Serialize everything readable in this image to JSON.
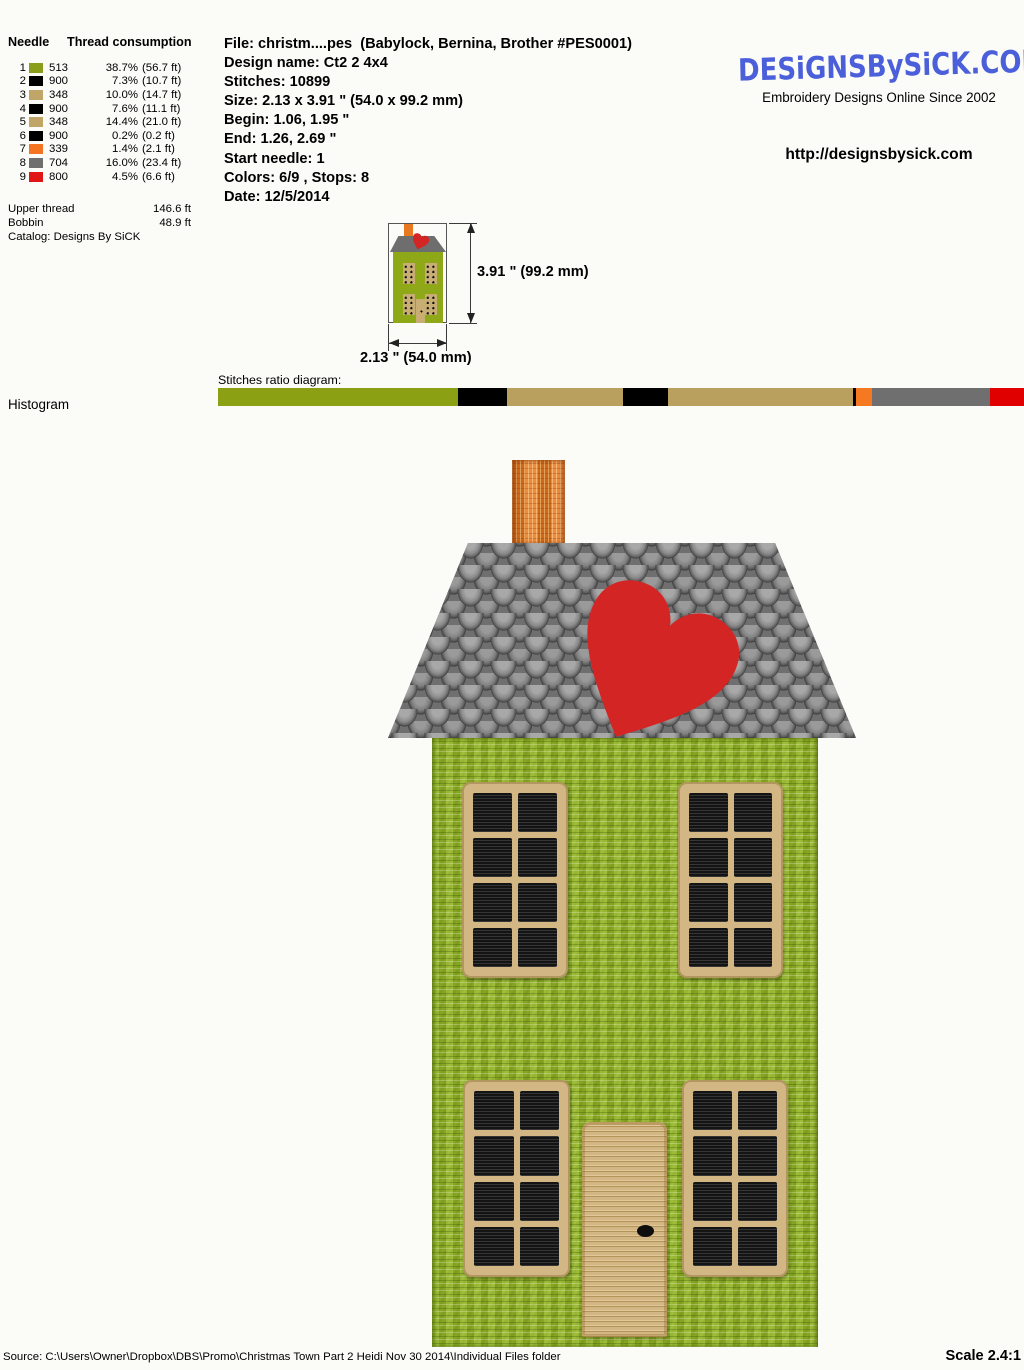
{
  "needle_table": {
    "col1_header": "Needle",
    "col2_header": "Thread consumption",
    "rows": [
      {
        "needle": "1",
        "color": "#8A9E1C",
        "code": "513",
        "percent": "38.7%",
        "length": "(56.7 ft)"
      },
      {
        "needle": "2",
        "color": "#000000",
        "code": "900",
        "percent": "7.3%",
        "length": "(10.7 ft)"
      },
      {
        "needle": "3",
        "color": "#C0A569",
        "code": "348",
        "percent": "10.0%",
        "length": "(14.7 ft)"
      },
      {
        "needle": "4",
        "color": "#000000",
        "code": "900",
        "percent": "7.6%",
        "length": "(11.1 ft)"
      },
      {
        "needle": "5",
        "color": "#C0A569",
        "code": "348",
        "percent": "14.4%",
        "length": "(21.0 ft)"
      },
      {
        "needle": "6",
        "color": "#000000",
        "code": "900",
        "percent": "0.2%",
        "length": "(0.2 ft)"
      },
      {
        "needle": "7",
        "color": "#F47421",
        "code": "339",
        "percent": "1.4%",
        "length": "(2.1 ft)"
      },
      {
        "needle": "8",
        "color": "#6F6F6F",
        "code": "704",
        "percent": "16.0%",
        "length": "(23.4 ft)"
      },
      {
        "needle": "9",
        "color": "#E01515",
        "code": "800",
        "percent": "4.5%",
        "length": "(6.6 ft)"
      }
    ],
    "upper_thread_label": "Upper thread",
    "upper_thread_value": "146.6 ft",
    "bobbin_label": "Bobbin",
    "bobbin_value": "48.9 ft",
    "catalog": "Catalog: Designs By SiCK"
  },
  "file_info": {
    "lines": [
      "File: christm....pes  (Babylock, Bernina, Brother #PES0001)",
      "Design name: Ct2 2 4x4",
      "Stitches: 10899",
      "Size: 2.13 x 3.91 \" (54.0 x 99.2 mm)",
      "Begin: 1.06, 1.95 \"",
      "End: 1.26, 2.69 \"",
      "Start needle: 1",
      "Colors: 6/9 , Stops: 8",
      "Date: 12/5/2014"
    ]
  },
  "branding": {
    "logo": "DESiGNSBySiCK.COM",
    "tagline": "Embroidery Designs Online Since 2002",
    "url": "http://designsbysick.com",
    "logo_color": "#4A5FD9"
  },
  "dimensions": {
    "height_label": "3.91 \" (99.2 mm)",
    "width_label": "2.13 \" (54.0 mm)"
  },
  "histogram": {
    "section_label": "Histogram",
    "bar_title": "Stitches ratio diagram:",
    "segments": [
      {
        "color": "#8CA014",
        "width_pct": 29.8
      },
      {
        "color": "#000000",
        "width_pct": 6.1
      },
      {
        "color": "#B9A05E",
        "width_pct": 14.4
      },
      {
        "color": "#000000",
        "width_pct": 5.5
      },
      {
        "color": "#B9A05E",
        "width_pct": 23.0
      },
      {
        "color": "#000000",
        "width_pct": 0.3
      },
      {
        "color": "#F47920",
        "width_pct": 2.1
      },
      {
        "color": "#6F6F6F",
        "width_pct": 14.6
      },
      {
        "color": "#E00000",
        "width_pct": 4.2
      }
    ]
  },
  "artwork": {
    "house_green": "#96B827",
    "roof_gray": "#6F6F6F",
    "heart_red": "#D42525",
    "chimney_orange": "#E8791E",
    "frame_tan": "#D2B683",
    "pane_black": "#141414",
    "mini_green": "#8FA818",
    "mini_roof": "#6E6E6E",
    "mini_tan": "#C9AE74",
    "logo_blue": "#4A5FD9"
  },
  "footer": {
    "source": "Source: C:\\Users\\Owner\\Dropbox\\DBS\\Promo\\Christmas Town Part 2 Heidi Nov 30 2014\\Individual Files folder",
    "scale": "Scale 2.4:1"
  }
}
